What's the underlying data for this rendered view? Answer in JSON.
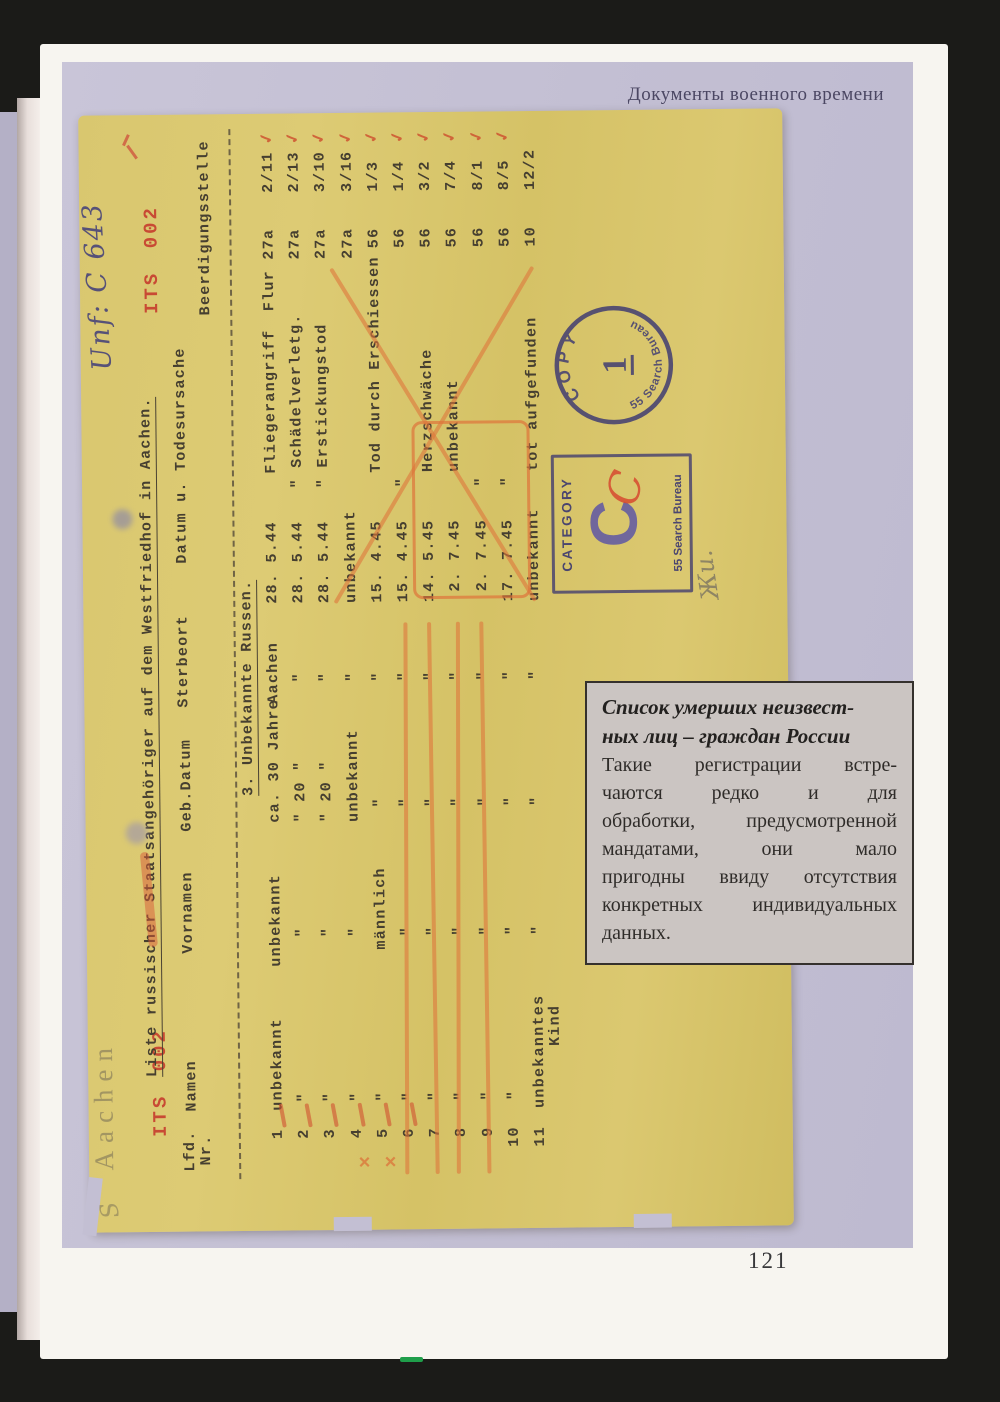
{
  "page": {
    "header": "Документы военного времени",
    "number": "121"
  },
  "doc": {
    "handwriting_s": "S",
    "handwriting_aachen": "Aachen",
    "handwriting_ref": "Unf: C 643",
    "handwriting_note": "Жи.",
    "its_stamp": "ITS 002",
    "title": "Liste russischer Staatsangehöriger auf dem Westfriedhof in Aachen.",
    "section": "3. Unbekannte Russen.",
    "columns": [
      "Lfd.",
      "Nr.",
      "Namen",
      "Vornamen",
      "Geb.Datum",
      "Sterbeort",
      "Datum u. Todesursache",
      "Beerdigungsstelle"
    ],
    "rows": [
      {
        "nr": "1",
        "name": "unbekannt",
        "vorname": "unbekannt",
        "geb": "ca. 30 Jahre",
        "ort": "Aachen",
        "date": "28. 5.44",
        "cause": "Fliegerangriff",
        "plot": "Flur 27a",
        "grave": "2/11"
      },
      {
        "nr": "2",
        "name": "\"",
        "vorname": "\"",
        "geb": "\" 20 \"",
        "ort": "\"",
        "date": "28. 5.44",
        "cause": "\" Schädelverletg.",
        "plot": "27a",
        "grave": "2/13"
      },
      {
        "nr": "3",
        "name": "\"",
        "vorname": "\"",
        "geb": "\" 20 \"",
        "ort": "\"",
        "date": "28. 5.44",
        "cause": "\" Erstickungstod",
        "plot": "27a",
        "grave": "3/10"
      },
      {
        "nr": "4",
        "name": "\"",
        "vorname": "\"",
        "geb": "unbekannt",
        "ort": "\"",
        "date": "unbekannt",
        "cause": "",
        "plot": "27a",
        "grave": "3/16"
      },
      {
        "nr": "5",
        "name": "\"",
        "vorname": "männlich",
        "geb": "\"",
        "ort": "\"",
        "date": "15. 4.45",
        "cause": "Tod durch Erschiessen",
        "plot": "56",
        "grave": "1/3"
      },
      {
        "nr": "6",
        "name": "\"",
        "vorname": "\"",
        "geb": "\"",
        "ort": "\"",
        "date": "15. 4.45",
        "cause": "\"",
        "plot": "56",
        "grave": "1/4"
      },
      {
        "nr": "7",
        "name": "\"",
        "vorname": "\"",
        "geb": "\"",
        "ort": "\"",
        "date": "14. 5.45",
        "cause": "Herzschwäche",
        "plot": "56",
        "grave": "3/2"
      },
      {
        "nr": "8",
        "name": "\"",
        "vorname": "\"",
        "geb": "\"",
        "ort": "\"",
        "date": " 2. 7.45",
        "cause": "unbekannt",
        "plot": "56",
        "grave": "7/4"
      },
      {
        "nr": "9",
        "name": "\"",
        "vorname": "\"",
        "geb": "\"",
        "ort": "\"",
        "date": " 2. 7.45",
        "cause": "\"",
        "plot": "56",
        "grave": "8/1"
      },
      {
        "nr": "10",
        "name": "\"",
        "vorname": "\"",
        "geb": "\"",
        "ort": "\"",
        "date": "17. 7.45",
        "cause": "\"",
        "plot": "56",
        "grave": "8/5"
      },
      {
        "nr": "11",
        "name": "unbekanntes\n      Kind",
        "vorname": "\"",
        "geb": "\"",
        "ort": "\"",
        "date": "unbekannt",
        "cause": "tot aufgefunden",
        "plot": "10",
        "grave": "12/2"
      }
    ],
    "stamps": {
      "copy": {
        "word": "COPY",
        "number": "1",
        "bureau": "55 Search Bureau"
      },
      "category": {
        "word": "CATEGORY",
        "letter": "C",
        "bureau": "55 Search Bureau"
      },
      "red_letter": "C"
    },
    "marks": {
      "check": "✓",
      "cross": "×"
    }
  },
  "caption": {
    "heading_lines": [
      "Список умерших неизвест-",
      "ных лиц – граждан России"
    ],
    "body_lines": [
      "Такие регистрации встре-",
      "чаются редко и для",
      "обработки, предусмотренной",
      "мандатами, они мало",
      "пригодны ввиду отсутствия",
      "конкретных индивидуальных",
      "данных."
    ]
  }
}
